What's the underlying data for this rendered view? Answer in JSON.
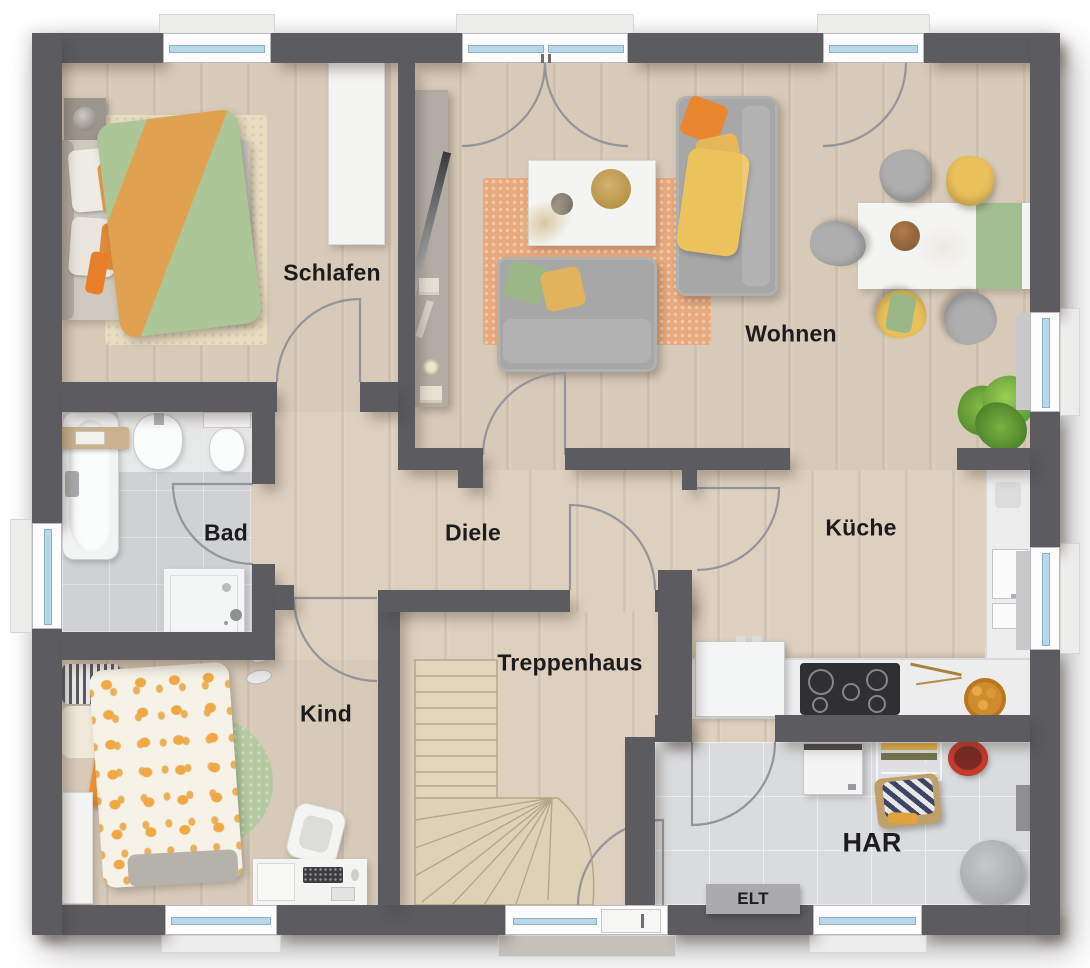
{
  "plan": {
    "rooms": {
      "schlafen": {
        "label": "Schlafen"
      },
      "wohnen": {
        "label": "Wohnen"
      },
      "bad": {
        "label": "Bad"
      },
      "diele": {
        "label": "Diele"
      },
      "kueche": {
        "label": "Küche"
      },
      "kind": {
        "label": "Kind"
      },
      "treppenhaus": {
        "label": "Treppenhaus"
      },
      "har": {
        "label": "HAR"
      },
      "elt": {
        "label": "ELT"
      }
    },
    "colors": {
      "wall": "#5b5b60",
      "wood_floor": "#d8cab8",
      "hall_floor": "#ddd0bf",
      "bath_tile": "#cfd1d3",
      "utility_tile": "#d9dbdd",
      "window_glass": "#b8d7e8",
      "accent_orange": "#e8872f",
      "accent_yellow": "#e9c05c",
      "accent_green": "#a9c493",
      "rug_orange": "#e9a97e",
      "rug_green": "#b5c9a0",
      "stair_wood": "#e0d3ba"
    }
  }
}
